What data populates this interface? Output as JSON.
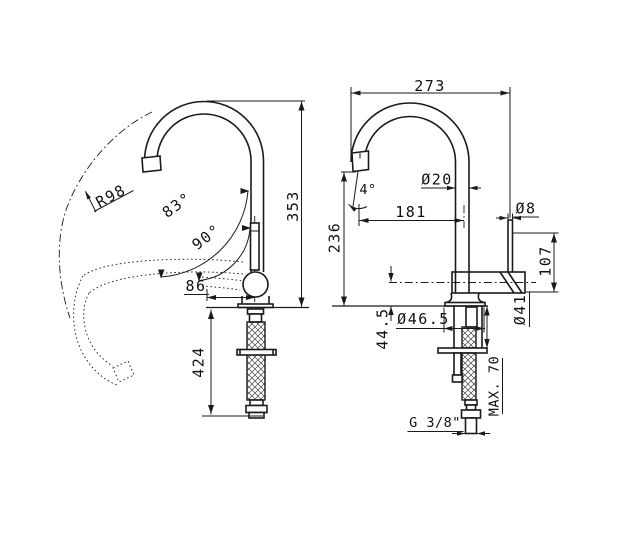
{
  "drawing_type": "faucet-technical-drawing",
  "front_view": {
    "swivel_radius": "R98",
    "swivel_angle_outer": "83°",
    "swivel_angle_inner": "90°",
    "spout_offset": "86",
    "overall_height": "353",
    "hose_length": "424"
  },
  "side_view": {
    "overall_depth": "273",
    "spout_tilt_angle": "4°",
    "spout_tube_diameter": "Ø20",
    "spout_reach": "181",
    "outlet_height": "236",
    "lever_diameter": "Ø8",
    "lever_height": "107",
    "body_diameter": "Ø41",
    "base_diameter": "Ø46.5",
    "base_height": "44.5",
    "max_counter_thickness": "MAX. 70",
    "supply_connection": "G 3/8\""
  }
}
